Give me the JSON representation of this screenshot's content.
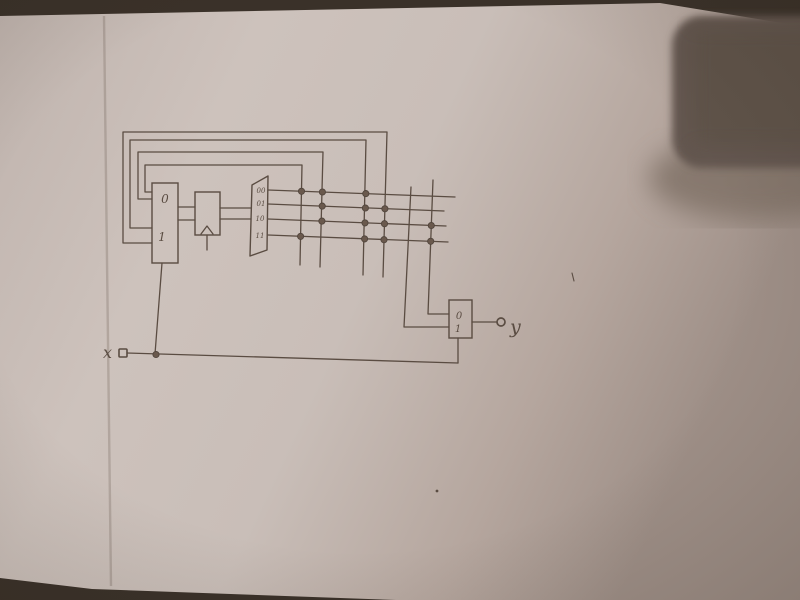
{
  "photo": {
    "background_color": "#3a3129",
    "paper_points": [
      [
        0,
        16
      ],
      [
        660,
        3
      ],
      [
        800,
        26
      ],
      [
        800,
        600
      ],
      [
        396,
        600
      ],
      [
        92,
        589
      ],
      [
        0,
        578
      ]
    ],
    "paper_gradient": [
      "#bfb3ad",
      "#cdc2bc",
      "#c9beb8",
      "#b5a69e",
      "#9e8f87"
    ],
    "fold_line": {
      "points": [
        [
          104,
          16
        ],
        [
          111,
          586
        ]
      ],
      "color": "rgba(108,93,83,0.28)"
    },
    "shadow_object": {
      "core_color": "#635750",
      "mid_color": "#5e524a",
      "fade_color": "#7e6f65"
    }
  },
  "diagram": {
    "pen_color": "#5a4c42",
    "dot_fill": "#6a594d",
    "dot_stroke": "#51453c",
    "stroke_width": 1.3,
    "blocks": [
      {
        "name": "next-state-mux-block",
        "x": 152,
        "y": 183,
        "w": 26,
        "h": 80,
        "labels": [
          {
            "text": "0",
            "x": 165,
            "y": 203,
            "size": 12
          },
          {
            "text": "1",
            "x": 162,
            "y": 241,
            "size": 12
          }
        ]
      },
      {
        "name": "state-register-block",
        "x": 195,
        "y": 192,
        "w": 25,
        "h": 43,
        "labels": []
      },
      {
        "name": "output-mux-block",
        "x": 449,
        "y": 300,
        "w": 23,
        "h": 38,
        "labels": [
          {
            "text": "0",
            "x": 459,
            "y": 319,
            "size": 10
          },
          {
            "text": "1",
            "x": 458,
            "y": 332,
            "size": 10
          }
        ]
      }
    ],
    "decoder": {
      "name": "state-decoder-block",
      "points": [
        [
          252,
          185
        ],
        [
          268,
          176
        ],
        [
          267,
          250
        ],
        [
          250,
          256
        ]
      ],
      "labels": [
        {
          "text": "00",
          "x": 261,
          "y": 193,
          "size": 7
        },
        {
          "text": "01",
          "x": 261,
          "y": 206,
          "size": 7
        },
        {
          "text": "10",
          "x": 260,
          "y": 221,
          "size": 7
        },
        {
          "text": "11",
          "x": 260,
          "y": 238,
          "size": 7
        }
      ]
    },
    "wires": [
      {
        "name": "feedback-column-d",
        "points": [
          [
            383,
            277
          ],
          [
            387,
            132
          ],
          [
            123,
            132
          ],
          [
            123,
            243
          ],
          [
            152,
            243
          ]
        ]
      },
      {
        "name": "feedback-column-c",
        "points": [
          [
            363,
            275
          ],
          [
            366,
            140
          ],
          [
            130,
            140
          ],
          [
            130,
            228
          ],
          [
            152,
            228
          ]
        ]
      },
      {
        "name": "feedback-column-b",
        "points": [
          [
            320,
            267
          ],
          [
            323,
            152
          ],
          [
            138,
            152
          ],
          [
            138,
            199
          ],
          [
            152,
            199
          ]
        ]
      },
      {
        "name": "feedback-column-a",
        "points": [
          [
            300,
            265
          ],
          [
            302,
            165
          ],
          [
            145,
            165
          ],
          [
            145,
            192
          ],
          [
            152,
            192
          ]
        ]
      },
      {
        "name": "matrix-row-1",
        "points": [
          [
            268,
            190
          ],
          [
            455,
            197
          ]
        ]
      },
      {
        "name": "matrix-row-2",
        "points": [
          [
            268,
            204
          ],
          [
            444,
            211
          ]
        ]
      },
      {
        "name": "matrix-row-3",
        "points": [
          [
            268,
            219
          ],
          [
            446,
            226
          ]
        ]
      },
      {
        "name": "matrix-row-4",
        "points": [
          [
            268,
            235
          ],
          [
            448,
            242
          ]
        ]
      },
      {
        "name": "column-e-to-output-mux",
        "points": [
          [
            411,
            187
          ],
          [
            404,
            327
          ],
          [
            449,
            327
          ]
        ]
      },
      {
        "name": "column-f-to-output-mux",
        "points": [
          [
            433,
            180
          ],
          [
            428,
            314
          ],
          [
            449,
            314
          ]
        ]
      },
      {
        "name": "mux-to-register-bit0",
        "points": [
          [
            178,
            207
          ],
          [
            195,
            207
          ]
        ]
      },
      {
        "name": "mux-to-register-bit1",
        "points": [
          [
            178,
            220
          ],
          [
            195,
            220
          ]
        ]
      },
      {
        "name": "register-to-decoder-bit0",
        "points": [
          [
            220,
            208
          ],
          [
            251,
            208
          ]
        ]
      },
      {
        "name": "register-to-decoder-bit1",
        "points": [
          [
            220,
            219
          ],
          [
            251,
            219
          ]
        ]
      },
      {
        "name": "register-clock-arrow",
        "points": [
          [
            201,
            234
          ],
          [
            207,
            226
          ],
          [
            213,
            234
          ]
        ]
      },
      {
        "name": "register-clock-stem",
        "points": [
          [
            207,
            235
          ],
          [
            207,
            250
          ]
        ]
      },
      {
        "name": "mux-select-line",
        "points": [
          [
            162,
            263
          ],
          [
            155,
            354
          ]
        ]
      },
      {
        "name": "x-input-line",
        "points": [
          [
            127,
            353
          ],
          [
            458,
            363
          ]
        ]
      },
      {
        "name": "output-mux-select-stem",
        "points": [
          [
            458,
            338
          ],
          [
            458,
            363
          ]
        ]
      },
      {
        "name": "output-mux-output-line",
        "points": [
          [
            472,
            322
          ],
          [
            497,
            322
          ]
        ]
      }
    ],
    "junction_dots": [
      [
        301.5,
        191.3
      ],
      [
        300.6,
        236.4
      ],
      [
        322.4,
        192.0
      ],
      [
        322.2,
        206.1
      ],
      [
        321.9,
        221.1
      ],
      [
        365.8,
        193.6
      ],
      [
        365.4,
        208.0
      ],
      [
        365.0,
        222.9
      ],
      [
        364.6,
        238.9
      ],
      [
        384.9,
        208.8
      ],
      [
        384.5,
        223.7
      ],
      [
        384.0,
        239.7
      ],
      [
        431.3,
        225.5
      ],
      [
        430.7,
        241.3
      ],
      [
        156.0,
        354.5
      ]
    ],
    "terminals": {
      "x_input_square": {
        "x": 119,
        "y": 349,
        "w": 8,
        "h": 8
      },
      "y_output_circle": {
        "cx": 501,
        "cy": 322,
        "r": 4
      }
    },
    "letters": [
      {
        "name": "x-input-label",
        "text": "x",
        "x": 103,
        "y": 358,
        "size": 16
      },
      {
        "name": "y-output-label",
        "text": "y",
        "x": 510,
        "y": 333,
        "size": 19
      }
    ],
    "stray_marks": {
      "tick": [
        [
          572,
          273
        ],
        [
          574,
          281
        ]
      ],
      "speck": {
        "cx": 437,
        "cy": 491,
        "r": 1.4
      }
    }
  }
}
